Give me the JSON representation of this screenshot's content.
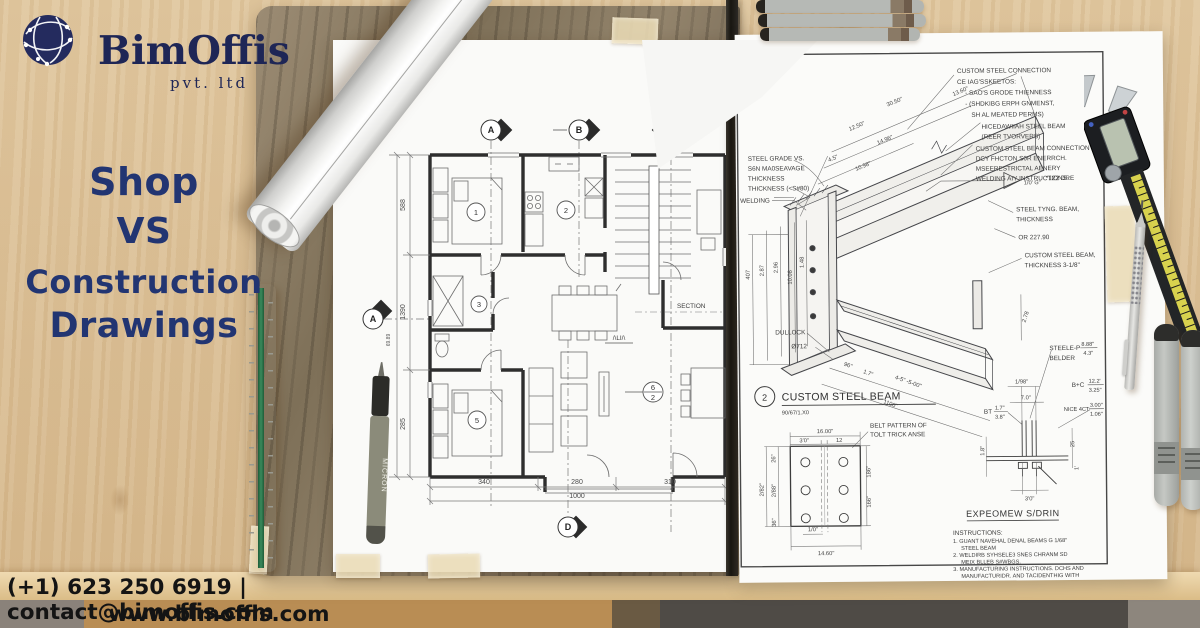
{
  "brand": {
    "name": "BimOffis",
    "suffix": "pvt. ltd"
  },
  "headline": {
    "l1": "Shop",
    "l2": "VS",
    "l3": "Construction",
    "l4": "Drawings"
  },
  "footer": {
    "contact": "(+1) 623 250 6919 | contact@bimoffis.com",
    "website": "www.bimoffis.com"
  },
  "colors": {
    "navy": "#223572",
    "logo_navy": "#1e2656",
    "ink": "#3c3c3c"
  },
  "tools": {
    "pen_label": "MICRON"
  },
  "floor_plan": {
    "markers": {
      "top_a": "A",
      "top_b": "B",
      "top_d": "D",
      "left_a": "A",
      "bottom_d": "D"
    },
    "rooms": {
      "r1": "1",
      "r2": "2",
      "r3": "3",
      "r5": "5"
    },
    "detail_ref": {
      "top": "6",
      "bottom": "2"
    },
    "dims_left": [
      "588",
      "1390",
      "285"
    ],
    "dim_small": "69.89",
    "dims_bottom": [
      "340",
      "280",
      "310"
    ],
    "dim_total": "1000",
    "section_label": "SECTION",
    "stair_label": "/\\LI/\\"
  },
  "shop": {
    "tr1": [
      "CUSTOM STEEL CONNECTION",
      "CE IAG'SSKEETOS:",
      "- SAO'S GRODE THIENNESS",
      "- (SHDKIBG ERPH GNMENST,",
      "SH AL MEATED PERMS)"
    ],
    "tr2": [
      "HICEDAWIIAH STEEL BEAM",
      "(REER TVORVERS)"
    ],
    "tr3": [
      "CUSTOM STEEL BEAM CONNECTION",
      "DCY FHCTON S0R ENERRCH.",
      "MSEERESTRICTAL AENERY",
      "WELDING AIY INSTRUCTIONS."
    ],
    "weld_note": "1/0' G\"",
    "weld_ref": "*122 DRE",
    "mr1a": "STEEL TYNG. BEAM,",
    "mr1b": "THICKNESS",
    "mr2": "OR 227.90",
    "mr3a": "CUSTOM STEEL BEAM,",
    "mr3b": "THICKNESS 3-1/8\"",
    "left_block": [
      "STEEL GRADE VS.",
      "S6N MA0SEAVAGE",
      "THICKNESS",
      "THICKNESS (<S#80)"
    ],
    "welding": "WELDING",
    "dullock": "DULLOCK",
    "dia": "Ø712",
    "diag_dims": [
      "30.50\"",
      "13.60\"",
      "12.50\"",
      "14.96\"",
      "4.5\"",
      "10.98\""
    ],
    "left_dims": [
      "407",
      "2.87",
      "2.96",
      "1.48",
      "10.08"
    ],
    "bottom_dims": [
      "96\"",
      "1.7\"",
      "4-5\" -5-00\"",
      "1100\""
    ],
    "dim_278": "2.78",
    "title_num": "2",
    "title": "CUSTOM STEEL BEAM",
    "title_sub": "90/67/1.X0",
    "plate": {
      "d16": "16.00\"",
      "d30": "3'0\"",
      "d12": "12",
      "d282": "2/82\"",
      "d288": "2/88\"",
      "d26": "26\"",
      "d36": "36\"",
      "d186": "186\"",
      "d166": "166\"",
      "d10": "1/0\"",
      "d1460": "14.60\"",
      "note1": "BELT PATTERN OF",
      "note2": "TOLT TRICK ANSE"
    },
    "sec": {
      "steele": "STEELE-P",
      "s_v1": "8.88\"",
      "s_v2": "4.3\"",
      "belder": "BELDER",
      "d198": "1/98\"",
      "d70": "7.0\"",
      "bc": "B+C",
      "bc_v1": "12.2'",
      "bc_v2": "3.25\"",
      "bt": "BT",
      "bt_v1": "1.7\"",
      "bt_v2": "3.8\"",
      "nice": "NICE 4CT",
      "n_v1": "3.00\"",
      "n_v2": "1.06\"",
      "d30": "3'0\"",
      "d25": "25",
      "d18": "1.8\"",
      "d1": "1'"
    },
    "expeo": "EXPEOMEW S/DRIN",
    "instr_title": "INSTRUCTIONS:",
    "instr": [
      "1. GUANT NAVEHAL DENAL BEAMS G 1/68\"",
      "STEEL BEAM",
      "2. WELDIRB SYHSELE3 SNES CHRANM SD",
      "MEIX BLLEB S#WBGS.",
      "3. MANUFACTURING INSTRUCTIONS. DCHS AND",
      "MANUFACTURIDR. AND TACIDENTHIG WITH",
      "NEERS GLUARD."
    ]
  }
}
